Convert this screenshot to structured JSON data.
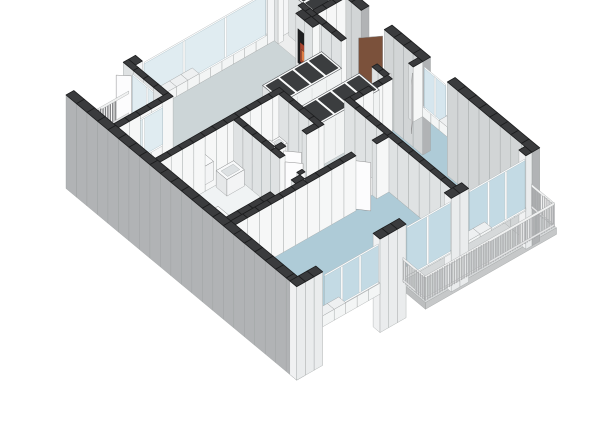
{
  "scene": {
    "width": 600,
    "height": 424,
    "background": "#ffffff",
    "description": "3D isometric floor plan render of an apartment"
  },
  "model": {
    "projection": {
      "ox": 66,
      "oy": 150,
      "ux": 0.868,
      "uy": -0.496,
      "vx": 0.769,
      "vy": 0.639,
      "hz": 55,
      "base": -0.7,
      "chunk": 14
    },
    "palette": {
      "wallTop": "#3a3b3d",
      "wallTopStroke": "#1c1d1e",
      "intSW": "#dfe2e3",
      "intSE": "#f6f7f7",
      "outerGray": "#b1b3b5",
      "outerGrayCap": "#bfc1c2",
      "neInner": "#d2d5d6",
      "nwInner": "#f4f5f6",
      "nwReveal": "#e8eaeb",
      "seOuter": "#eaeced",
      "seReveal": "#f0f1f2",
      "sillTop": "#eef0f1",
      "sillFace": "#f3f5f5",
      "faceStroke": "#9a9d9e",
      "glass_nw": "#e0ecf1",
      "glass_ne": "#d6e6ee",
      "glass_se": "#c3dae4",
      "frame": "#fdfdfd",
      "frameStroke": "#aab0b2",
      "leafWhite": "#fcfcfd",
      "leafBrown": "#7b513b",
      "leafStroke": "#8f8f90",
      "slatLight": "#c6c8c9",
      "slatLightStroke": "#8a8c8d",
      "slatDark": "#88898b",
      "slatDarkStroke": "#5c5d5f",
      "railTop": "#f0f1f1",
      "railStroke": "#9a9c9d",
      "furnTop": "#f8f9fa",
      "furnSW": "#e6e8e9",
      "furnSE": "#f3f4f5",
      "furnStroke": "#77797b",
      "cubbyTop": "#fafbfb",
      "cubbyCell": "#3b3d3f",
      "cubbySeam": "#d8dada",
      "cubbyStroke": "#57595c",
      "cooktop": "#2b2d2f",
      "sinkInner": "#d4d8da",
      "tubInset": "#e7ebec",
      "basinInset": "#dde1e3",
      "fasciaSE": "#c6c8c9",
      "fasciaSW": "#bcbebf",
      "metal": "#606365"
    },
    "floors": [
      {
        "name": "floor-living-room",
        "color": "#ccd5d7",
        "poly": [
          [
            9,
            106
          ],
          [
            9,
            58
          ],
          [
            72,
            58
          ],
          [
            72,
            9
          ],
          [
            232,
            9
          ],
          [
            232,
            152
          ],
          [
            192,
            152
          ],
          [
            192,
            158
          ],
          [
            152,
            158
          ],
          [
            152,
            106
          ]
        ]
      },
      {
        "name": "floor-hall",
        "color": "#edeeee",
        "rect": [
          232,
          58,
          271,
          152
        ]
      },
      {
        "name": "floor-storage",
        "color": "#edeeee",
        "rect": [
          232,
          9,
          271,
          58
        ]
      },
      {
        "name": "floor-entry-threshold",
        "color": "#e4e6e6",
        "rect": [
          271,
          78,
          280,
          108
        ]
      },
      {
        "name": "floor-corridor",
        "color": "#edeeee",
        "poly": [
          [
            94,
            164
          ],
          [
            152,
            164
          ],
          [
            152,
            158
          ],
          [
            192,
            158
          ],
          [
            192,
            204
          ],
          [
            94,
            204
          ]
        ]
      },
      {
        "name": "floor-bathroom",
        "color": "#f0f3f4",
        "rect": [
          9,
          112,
          94,
          204
        ]
      },
      {
        "name": "floor-shower",
        "color": "#cde5f1",
        "rect": [
          66,
          170,
          92,
          196
        ]
      },
      {
        "name": "floor-toilet",
        "color": "#41aadc",
        "rect": [
          100,
          112,
          146,
          164
        ]
      },
      {
        "name": "floor-bedroom-1",
        "color": "#aecbd7",
        "rect": [
          9,
          204,
          186,
          291
        ]
      },
      {
        "name": "floor-bedroom-2",
        "color": "#aecbd7",
        "rect": [
          186,
          152,
          271,
          291
        ]
      },
      {
        "name": "floor-balcony-nw",
        "color": "#dadcdd",
        "rect": [
          9,
          0,
          72,
          52
        ]
      },
      {
        "name": "floor-balcony-se",
        "color": "#d6d9da",
        "rect": [
          120,
          300,
          271,
          332
        ],
        "fascia": true
      }
    ],
    "walls": [
      {
        "r": [
          72,
          0,
          80,
          9
        ],
        "k": "nw"
      },
      {
        "r": [
          224,
          0,
          280,
          9
        ],
        "k": "nw"
      },
      {
        "r": [
          80,
          0,
          224,
          9
        ],
        "k": "sill",
        "z": [
          0,
          0.18
        ]
      },
      {
        "r": [
          0,
          0,
          9,
          300
        ],
        "k": "sw"
      },
      {
        "r": [
          271,
          0,
          280,
          78
        ],
        "k": "ne"
      },
      {
        "r": [
          271,
          108,
          280,
          158
        ],
        "k": "ne"
      },
      {
        "r": [
          271,
          190,
          280,
          300
        ],
        "k": "ne"
      },
      {
        "r": [
          271,
          158,
          280,
          190
        ],
        "k": "sill",
        "z": [
          0,
          0.18
        ]
      },
      {
        "r": [
          0,
          291,
          30,
          300
        ],
        "k": "se"
      },
      {
        "r": [
          96,
          291,
          126,
          300
        ],
        "k": "se"
      },
      {
        "r": [
          178,
          291,
          198,
          300
        ],
        "k": "se"
      },
      {
        "r": [
          264,
          291,
          271,
          300
        ],
        "k": "se"
      },
      {
        "r": [
          30,
          291,
          96,
          300
        ],
        "k": "sill",
        "z": [
          0,
          0.2
        ]
      },
      {
        "r": [
          126,
          291,
          178,
          300
        ],
        "k": "sill",
        "z": [
          0,
          0.05
        ]
      },
      {
        "r": [
          198,
          291,
          264,
          300
        ],
        "k": "sill",
        "z": [
          0,
          0.05
        ]
      },
      {
        "r": [
          66,
          0,
          72,
          52
        ],
        "k": "int"
      },
      {
        "r": [
          9,
          52,
          72,
          58
        ],
        "k": "int"
      },
      {
        "r": [
          9,
          106,
          152,
          112
        ],
        "k": "int"
      },
      {
        "r": [
          94,
          112,
          100,
          172
        ],
        "k": "int"
      },
      {
        "r": [
          94,
          194,
          100,
          198
        ],
        "k": "int"
      },
      {
        "r": [
          146,
          112,
          152,
          164
        ],
        "k": "int"
      },
      {
        "r": [
          9,
          198,
          60,
          204
        ],
        "k": "int"
      },
      {
        "r": [
          84,
          198,
          94,
          204
        ],
        "k": "int"
      },
      {
        "r": [
          100,
          158,
          108,
          164
        ],
        "k": "int"
      },
      {
        "r": [
          132,
          158,
          146,
          164
        ],
        "k": "int"
      },
      {
        "r": [
          9,
          204,
          148,
          210
        ],
        "k": "int"
      },
      {
        "r": [
          172,
          204,
          186,
          210
        ],
        "k": "int"
      },
      {
        "r": [
          186,
          152,
          192,
          291
        ],
        "k": "int"
      },
      {
        "r": [
          192,
          152,
          236,
          158
        ],
        "k": "int"
      },
      {
        "r": [
          260,
          152,
          271,
          158
        ],
        "k": "int"
      },
      {
        "r": [
          232,
          58,
          238,
          96
        ],
        "k": "int"
      },
      {
        "r": [
          232,
          136,
          238,
          152
        ],
        "k": "int"
      },
      {
        "r": [
          232,
          9,
          238,
          14
        ],
        "k": "int"
      },
      {
        "r": [
          232,
          40,
          238,
          58
        ],
        "k": "int"
      },
      {
        "r": [
          238,
          52,
          271,
          58
        ],
        "k": "int"
      },
      {
        "r": [
          224,
          46,
          232,
          68
        ],
        "k": "int",
        "name": "fireplace-column"
      }
    ],
    "windows": [
      {
        "name": "window-living-nw",
        "face": "y",
        "at": 9,
        "from": 82,
        "to": 222,
        "z": [
          0.2,
          0.93
        ],
        "glass": "glass_nw",
        "mullions": [
          128,
          176
        ]
      },
      {
        "name": "window-balcony-door",
        "face": "x",
        "at": 66,
        "from": 12,
        "to": 50,
        "z": [
          0.2,
          0.9
        ],
        "glass": "glass_nw",
        "mullions": [
          31
        ]
      },
      {
        "name": "window-balcony-side",
        "face": "y",
        "at": 58,
        "from": 16,
        "to": 60,
        "z": [
          0.24,
          0.9
        ],
        "glass": "glass_nw",
        "mullions": [
          38
        ]
      },
      {
        "name": "window-bedroom2-ne",
        "face": "x",
        "at": 271,
        "from": 160,
        "to": 188,
        "z": [
          0.2,
          0.9
        ],
        "glass": "glass_ne",
        "mullions": [
          174
        ]
      },
      {
        "name": "window-bedroom1-se",
        "face": "y",
        "at": 300,
        "from": 32,
        "to": 94,
        "z": [
          0.24,
          0.9
        ],
        "glass": "glass_se",
        "mullions": [
          52,
          73
        ]
      },
      {
        "name": "window-door-se-1",
        "face": "y",
        "at": 300,
        "from": 127,
        "to": 177,
        "z": [
          0.05,
          0.92
        ],
        "glass": "glass_se",
        "mullions": [
          151
        ]
      },
      {
        "name": "window-door-se-2",
        "face": "y",
        "at": 300,
        "from": 199,
        "to": 263,
        "z": [
          0.05,
          0.92
        ],
        "glass": "glass_se",
        "mullions": [
          221,
          241
        ]
      }
    ],
    "leaves": [
      {
        "name": "door-leaf-balcony",
        "p": [
          [
            66,
            11
          ],
          [
            56,
            2
          ]
        ],
        "color": "leafWhite"
      },
      {
        "name": "door-leaf-bathroom",
        "p": [
          [
            100,
            172
          ],
          [
            111,
            183
          ]
        ],
        "color": "leafWhite"
      },
      {
        "name": "door-leaf-toilet",
        "p": [
          [
            108,
            161
          ],
          [
            119,
            172
          ]
        ],
        "color": "leafWhite"
      },
      {
        "name": "door-leaf-bedroom1",
        "p": [
          [
            148,
            207
          ],
          [
            158,
            218
          ]
        ],
        "color": "leafWhite"
      },
      {
        "name": "door-leaf-bedroom2",
        "p": [
          [
            260,
            157
          ],
          [
            249,
            168
          ]
        ],
        "color": "leafWhite"
      },
      {
        "name": "door-leaf-hall",
        "p": [
          [
            235,
            136
          ],
          [
            245,
            146
          ]
        ],
        "color": "leafWhite"
      },
      {
        "name": "front-door-leaf",
        "p": [
          [
            270,
            107
          ],
          [
            252,
            96
          ]
        ],
        "color": "leafBrown"
      }
    ],
    "railings": [
      {
        "name": "railing-balcony-nw",
        "p": [
          [
            10,
            1.5
          ],
          [
            71,
            1.5
          ]
        ],
        "dark": true
      },
      {
        "name": "railing-balcony-se-long",
        "p": [
          [
            121,
            330
          ],
          [
            270,
            330
          ]
        ]
      },
      {
        "name": "railing-balcony-se-west",
        "p": [
          [
            121.5,
            301
          ],
          [
            121.5,
            329
          ]
        ]
      },
      {
        "name": "railing-balcony-se-east",
        "p": [
          [
            269.5,
            301
          ],
          [
            269.5,
            329
          ]
        ]
      }
    ],
    "furniture": [
      {
        "name": "kitchen-counter",
        "type": "box",
        "rect": [
          14,
          88,
          76,
          106
        ],
        "h": 0.34,
        "decals": [
          {
            "type": "rectTop",
            "r": [
              22,
              91,
              40,
              103
            ],
            "color": "cooktop",
            "stroke": "#17181a"
          },
          {
            "type": "rectTop",
            "r": [
              49,
              91,
              66,
              103
            ],
            "color": "#eef0f1",
            "stroke": "#999c9d"
          },
          {
            "type": "rectTop",
            "r": [
              51,
              92.5,
              64,
              101.5
            ],
            "color": "sinkInner",
            "stroke": "#8e9192"
          }
        ]
      },
      {
        "name": "bathtub",
        "type": "box",
        "rect": [
          13,
          148,
          44,
          196
        ],
        "h": 0.3,
        "decals": [
          {
            "type": "rectTop",
            "r": [
              16,
              151.5,
              41,
              192
            ],
            "color": "tubInset",
            "stroke": "#b3b7b8"
          }
        ]
      },
      {
        "name": "washbasin",
        "type": "box",
        "rect": [
          72,
          114,
          92,
          128
        ],
        "h": 0.3,
        "decals": [
          {
            "type": "rectTop",
            "r": [
              75,
              117,
              89,
              125.5
            ],
            "color": "basinInset",
            "stroke": "#a4a8a9"
          }
        ]
      },
      {
        "name": "toilet-corner-basin",
        "type": "box",
        "rect": [
          135,
          114,
          145,
          124
        ],
        "h": 0.26,
        "decals": [
          {
            "type": "rectTop",
            "r": [
              137,
              116,
              143,
              122
            ],
            "color": "basinInset",
            "stroke": "#a4a8a9"
          }
        ]
      },
      {
        "name": "toilet-tank",
        "type": "box",
        "rect": [
          118,
          114,
          134,
          121
        ],
        "h": 0.3,
        "decals": []
      },
      {
        "name": "toilet-bowl",
        "type": "box",
        "rect": [
          120,
          122,
          132,
          137
        ],
        "h": 0.22,
        "decals": [
          {
            "type": "disc",
            "c": [
              126,
              129.5
            ],
            "r": 6,
            "z": 0.22,
            "color": "#ffffff",
            "stroke": "#8e9192"
          }
        ]
      },
      {
        "name": "wardrobe-bank-a",
        "type": "bank",
        "rect": [
          152,
          84,
          220,
          110
        ],
        "h": 0.78,
        "cells": 4,
        "axis": "x"
      },
      {
        "name": "wardrobe-bank-b",
        "type": "bank",
        "rect": [
          160,
          124,
          228,
          150
        ],
        "h": 0.78,
        "cells": 4,
        "axis": "x"
      },
      {
        "name": "storage-cabinet",
        "type": "bank",
        "rect": [
          246,
          12,
          268,
          48
        ],
        "h": 0.8,
        "cells": 2,
        "axis": "y"
      }
    ],
    "fireplace": {
      "name": "fireplace",
      "panel": {
        "p": [
          [
            223.7,
            49
          ],
          [
            223.7,
            65
          ]
        ],
        "z": [
          0.14,
          0.76
        ],
        "color": "#1e1f21"
      },
      "glow": {
        "p": [
          [
            223.5,
            52
          ],
          [
            223.5,
            62
          ]
        ],
        "z": [
          0.2,
          0.55
        ],
        "color": "#a84530"
      },
      "core": {
        "p": [
          [
            223.3,
            54
          ],
          [
            223.3,
            60
          ]
        ],
        "z": [
          0.25,
          0.44
        ],
        "color": "#e07d45"
      }
    },
    "faucets": [
      {
        "name": "sink-faucet",
        "pts": [
          [
            57,
            90,
            0.34
          ],
          [
            57,
            90,
            0.52
          ],
          [
            61,
            93.5,
            0.52
          ]
        ]
      },
      {
        "name": "tub-faucet",
        "pts": [
          [
            28,
            153,
            0.3
          ],
          [
            28,
            153,
            0.46
          ],
          [
            31.5,
            156,
            0.46
          ]
        ]
      }
    ]
  }
}
